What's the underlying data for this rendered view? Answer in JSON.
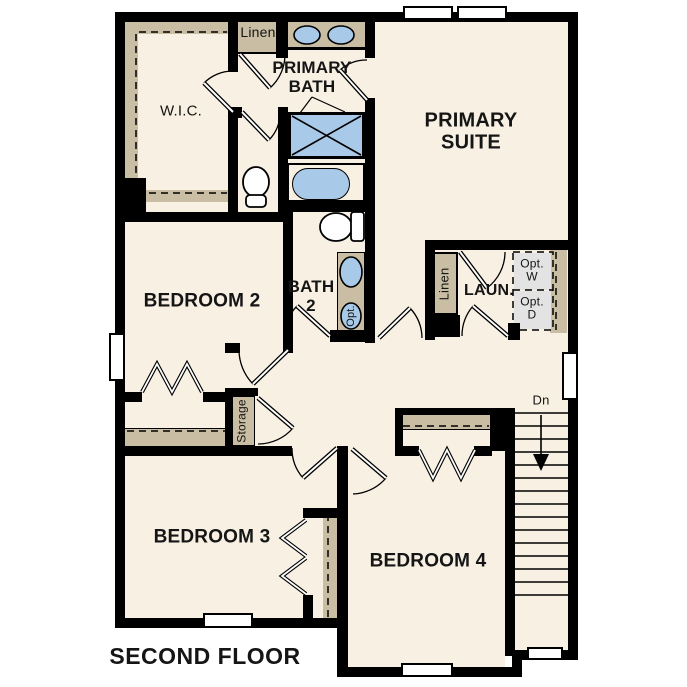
{
  "floor_title": "SECOND FLOOR",
  "palette": {
    "background": "#ffffff",
    "floor": "#f7f0e3",
    "wall": "#000000",
    "casework": "#c9bda3",
    "fixture_blue": "#a9c9e9",
    "optional_gray": "#e3e3e3"
  },
  "rooms": {
    "wic": {
      "label": "W.I.C."
    },
    "primary_bath": {
      "label": "PRIMARY\nBATH"
    },
    "primary_suite": {
      "label": "PRIMARY\nSUITE"
    },
    "bedroom2": {
      "label": "BEDROOM 2"
    },
    "bath2": {
      "label": "BATH\n2"
    },
    "laundry": {
      "label": "LAUN."
    },
    "bedroom3": {
      "label": "BEDROOM 3"
    },
    "bedroom4": {
      "label": "BEDROOM 4"
    }
  },
  "closets": {
    "linen_hall": {
      "label": "Linen"
    },
    "linen_laundry": {
      "label": "Linen"
    },
    "storage": {
      "label": "Storage"
    }
  },
  "annotations": {
    "stairs_down": {
      "label": "Dn"
    },
    "optional_washer": {
      "label": "Opt.\nW"
    },
    "optional_dryer": {
      "label": "Opt.\nD"
    },
    "optional_sink": {
      "label": "Opt."
    }
  },
  "stairs": {
    "tread_count": 15
  }
}
